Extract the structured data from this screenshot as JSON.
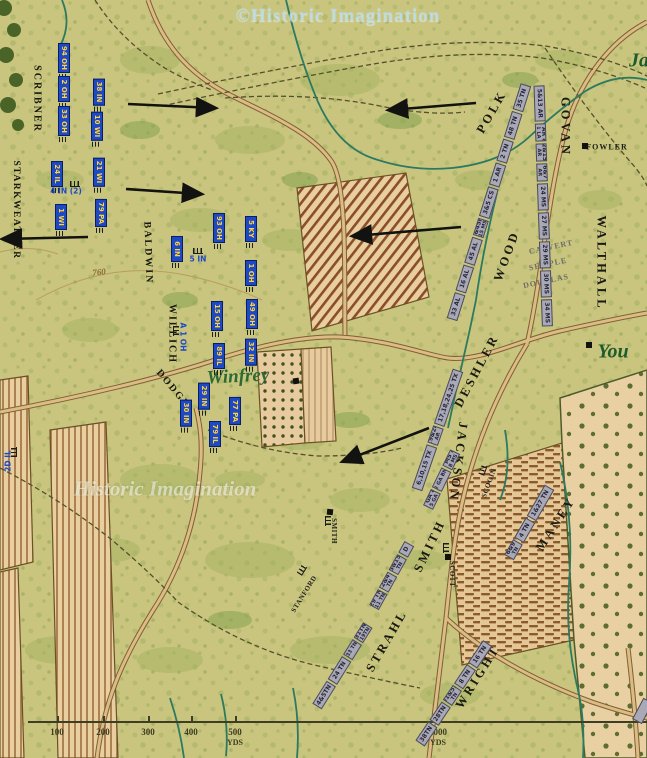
{
  "colors": {
    "union_blue": "#1e49c4",
    "union_text": "#ffd23c",
    "confederate_bar": "#a8a8b6",
    "confederate_text": "#26263a",
    "map_base": "#c9c47e"
  },
  "watermarks": {
    "top": "©Historic Imagination",
    "middle": "Historic Imagination"
  },
  "scale_bar": {
    "ticks": [
      {
        "label": "100",
        "x": 57
      },
      {
        "label": "200",
        "x": 103
      },
      {
        "label": "300",
        "x": 148
      },
      {
        "label": "400",
        "x": 191
      },
      {
        "label": "500",
        "x": 235,
        "unit": "YDS"
      },
      {
        "label": "1000",
        "x": 438,
        "unit": "YDS"
      }
    ]
  },
  "terrain_labels": [
    {
      "text": "Winfrey",
      "x": 238,
      "y": 377,
      "rot": -3,
      "cls": "place-green"
    },
    {
      "text": "You",
      "x": 613,
      "y": 352,
      "rot": 0,
      "cls": "place-green lg"
    },
    {
      "text": "Ja",
      "x": 639,
      "y": 61,
      "rot": 0,
      "cls": "place-green lg"
    },
    {
      "text": "FOWLER",
      "x": 607,
      "y": 147,
      "rot": 0,
      "cls": "farm"
    },
    {
      "text": "SMITH",
      "x": 334,
      "y": 531,
      "rot": 90,
      "cls": "farm sm"
    },
    {
      "text": "SCOTT",
      "x": 452,
      "y": 574,
      "rot": 90,
      "cls": "farm sm"
    },
    {
      "text": "STANFORD",
      "x": 304,
      "y": 594,
      "rot": -58,
      "cls": "farm sm"
    },
    {
      "text": "SCOGIN",
      "x": 489,
      "y": 483,
      "rot": -70,
      "cls": "farm sm"
    },
    {
      "text": "760",
      "x": 99,
      "y": 272,
      "rot": -6,
      "cls": "contour"
    }
  ],
  "union": {
    "brigades": [
      {
        "text": "SCRIBNER",
        "x": 37,
        "y": 99,
        "rot": 90
      },
      {
        "text": "STARKWEATHER",
        "x": 16,
        "y": 210,
        "rot": 90,
        "long": true
      },
      {
        "text": "BALDWIN",
        "x": 148,
        "y": 253,
        "rot": 88
      },
      {
        "text": "WILLICH",
        "x": 172,
        "y": 334,
        "rot": 90
      },
      {
        "text": "DODGE",
        "x": 173,
        "y": 389,
        "rot": 50
      }
    ],
    "units": [
      {
        "text": "94 OH",
        "x": 64,
        "y": 58
      },
      {
        "text": "2 OH",
        "x": 64,
        "y": 89
      },
      {
        "text": "33 OH",
        "x": 64,
        "y": 121
      },
      {
        "text": "38 IN",
        "x": 99,
        "y": 92
      },
      {
        "text": "10 WI",
        "x": 97,
        "y": 126
      },
      {
        "text": "24 IL",
        "x": 57,
        "y": 174
      },
      {
        "text": "21 WI",
        "x": 99,
        "y": 172
      },
      {
        "text": "1 WI",
        "x": 61,
        "y": 217
      },
      {
        "text": "79 PA",
        "x": 101,
        "y": 213
      },
      {
        "text": "6 IN",
        "x": 177,
        "y": 249
      },
      {
        "text": "93 OH",
        "x": 219,
        "y": 228
      },
      {
        "text": "5 KY",
        "x": 251,
        "y": 229
      },
      {
        "text": "1 OH",
        "x": 251,
        "y": 273
      },
      {
        "text": "15 OH",
        "x": 217,
        "y": 316
      },
      {
        "text": "49 OH",
        "x": 252,
        "y": 314
      },
      {
        "text": "89 IL",
        "x": 219,
        "y": 356
      },
      {
        "text": "32 IN",
        "x": 251,
        "y": 352
      },
      {
        "text": "29 IN",
        "x": 204,
        "y": 396
      },
      {
        "text": "30 IN",
        "x": 186,
        "y": 413
      },
      {
        "text": "77 PA",
        "x": 235,
        "y": 411
      },
      {
        "text": "79 IL",
        "x": 215,
        "y": 434
      }
    ],
    "batteries": [
      {
        "text": "4 IN (2)",
        "x": 66,
        "y": 191,
        "rot": 0
      },
      {
        "text": "5 IN",
        "x": 198,
        "y": 259,
        "rot": 0
      },
      {
        "text": "A 1 OH",
        "x": 183,
        "y": 337,
        "rot": 90
      },
      {
        "text": "2D IL",
        "x": 8,
        "y": 461,
        "rot": -90
      }
    ]
  },
  "confederate": {
    "brigades": [
      {
        "text": "POLK",
        "x": 492,
        "y": 112,
        "rot": -60
      },
      {
        "text": "GOVAN",
        "x": 565,
        "y": 127,
        "rot": 90
      },
      {
        "text": "WOOD",
        "x": 507,
        "y": 256,
        "rot": -70
      },
      {
        "text": "WALTHALL",
        "x": 601,
        "y": 263,
        "rot": 90
      },
      {
        "text": "DESHLER",
        "x": 477,
        "y": 371,
        "rot": -62
      },
      {
        "text": "JACKSON",
        "x": 458,
        "y": 462,
        "rot": 97
      },
      {
        "text": "SMITH",
        "x": 430,
        "y": 546,
        "rot": -64
      },
      {
        "text": "MANEY",
        "x": 556,
        "y": 524,
        "rot": -57
      },
      {
        "text": "STRAHL",
        "x": 387,
        "y": 641,
        "rot": -60
      },
      {
        "text": "WRIGHT",
        "x": 478,
        "y": 677,
        "rot": -58
      }
    ],
    "battery_names": [
      {
        "text": "CALVERT",
        "x": 551,
        "y": 247,
        "rot": -12
      },
      {
        "text": "SEMPLE",
        "x": 548,
        "y": 264,
        "rot": -12
      },
      {
        "text": "DOUGLAS",
        "x": 546,
        "y": 281,
        "rot": -12
      }
    ],
    "lines": [
      {
        "id": "wood-polk",
        "x": 452,
        "y": 320,
        "rot": -72.5,
        "segments": [
          {
            "t": "33 AL"
          },
          {
            "t": "16 AL"
          },
          {
            "t": "45 AL"
          },
          {
            "t": "32&45MS",
            "t2": "15 MS"
          },
          {
            "t": "3&5 CS"
          },
          {
            "t": "1 AR"
          },
          {
            "t": "2 TN"
          },
          {
            "t": "48 TN"
          },
          {
            "t": "35 TN"
          }
        ]
      },
      {
        "id": "govan-walthall",
        "x": 539,
        "y": 86,
        "rot": 88,
        "segments": [
          {
            "t": "5&13 AR"
          },
          {
            "t": "8 AR &",
            "t2": "1 LA"
          },
          {
            "t": "2&15",
            "t2": "AR"
          },
          {
            "t": "6&7",
            "t2": "AR"
          },
          {
            "t": "24 MS"
          },
          {
            "t": "27 MS"
          },
          {
            "t": "29 MS"
          },
          {
            "t": "30 MS"
          },
          {
            "t": "34 MS"
          }
        ]
      },
      {
        "id": "deshler",
        "x": 417,
        "y": 490,
        "rot": -71,
        "segments": [
          {
            "t": "6,10,15 TX",
            "w": 46
          },
          {
            "t": "19&24",
            "t2": "AR"
          },
          {
            "t": "17,18,24,25 TX",
            "w": 58
          }
        ]
      },
      {
        "id": "jackson",
        "x": 428,
        "y": 508,
        "rot": -64,
        "segments": [
          {
            "t": "1 GA &",
            "t2": "5 GA"
          },
          {
            "t": "2 GA BN",
            "small": true,
            "w": 22
          },
          {
            "t": "5 MS &",
            "t2": "8 MS"
          }
        ]
      },
      {
        "id": "smith",
        "x": 374,
        "y": 608,
        "rot": -61,
        "segments": [
          {
            "t": "29 TN",
            "t2": "11 TN"
          },
          {
            "t": "12&47",
            "t2": "TN"
          },
          {
            "t": "13&154",
            "t2": "TN"
          },
          {
            "t": "D",
            "w": 13
          }
        ]
      },
      {
        "id": "strahl",
        "x": 317,
        "y": 707,
        "rot": -58,
        "segments": [
          {
            "t": "4&5TN"
          },
          {
            "t": "24 TN"
          },
          {
            "t": "33 TN",
            "small": true,
            "w": 18
          },
          {
            "t": "31TN",
            "t2": "19TN"
          }
        ]
      },
      {
        "id": "wright",
        "x": 420,
        "y": 744,
        "rot": -56,
        "segments": [
          {
            "t": "38TN"
          },
          {
            "t": "28TN"
          },
          {
            "t": "51&52",
            "t2": "TN"
          },
          {
            "t": "8 TN"
          },
          {
            "t": "16 TN"
          }
        ]
      },
      {
        "id": "maney",
        "x": 509,
        "y": 558,
        "rot": -60,
        "segments": [
          {
            "t": "6&9",
            "t2": "TN"
          },
          {
            "t": "4 TN"
          },
          {
            "t": "1&27 TN",
            "w": 36
          }
        ]
      },
      {
        "id": "edge-fragment",
        "x": 637,
        "y": 722,
        "rot": -62,
        "segments": [
          {
            "t": "",
            "w": 24
          }
        ]
      }
    ]
  },
  "houses": [
    {
      "x": 585,
      "y": 146,
      "rot": 0
    },
    {
      "x": 296,
      "y": 381,
      "rot": -8
    },
    {
      "x": 330,
      "y": 512,
      "rot": 6
    },
    {
      "x": 448,
      "y": 557,
      "rot": 0
    },
    {
      "x": 589,
      "y": 345,
      "rot": 0
    }
  ],
  "battery_markers": [
    {
      "x": 75,
      "y": 184,
      "rot": 0
    },
    {
      "x": 198,
      "y": 251,
      "rot": 0
    },
    {
      "x": 176,
      "y": 331,
      "rot": 90
    },
    {
      "x": 14,
      "y": 452,
      "rot": -90
    },
    {
      "x": 328,
      "y": 521,
      "rot": 90
    },
    {
      "x": 446,
      "y": 548,
      "rot": 90
    },
    {
      "x": 302,
      "y": 570,
      "rot": -58
    },
    {
      "x": 483,
      "y": 470,
      "rot": -70
    }
  ],
  "arrows": [
    {
      "x1": 128,
      "y1": 104,
      "x2": 214,
      "y2": 108
    },
    {
      "x1": 126,
      "y1": 189,
      "x2": 200,
      "y2": 194
    },
    {
      "x1": 476,
      "y1": 103,
      "x2": 390,
      "y2": 110
    },
    {
      "x1": 461,
      "y1": 227,
      "x2": 354,
      "y2": 236
    },
    {
      "x1": 429,
      "y1": 428,
      "x2": 344,
      "y2": 461
    },
    {
      "x1": 88,
      "y1": 237,
      "x2": 4,
      "y2": 239
    }
  ]
}
